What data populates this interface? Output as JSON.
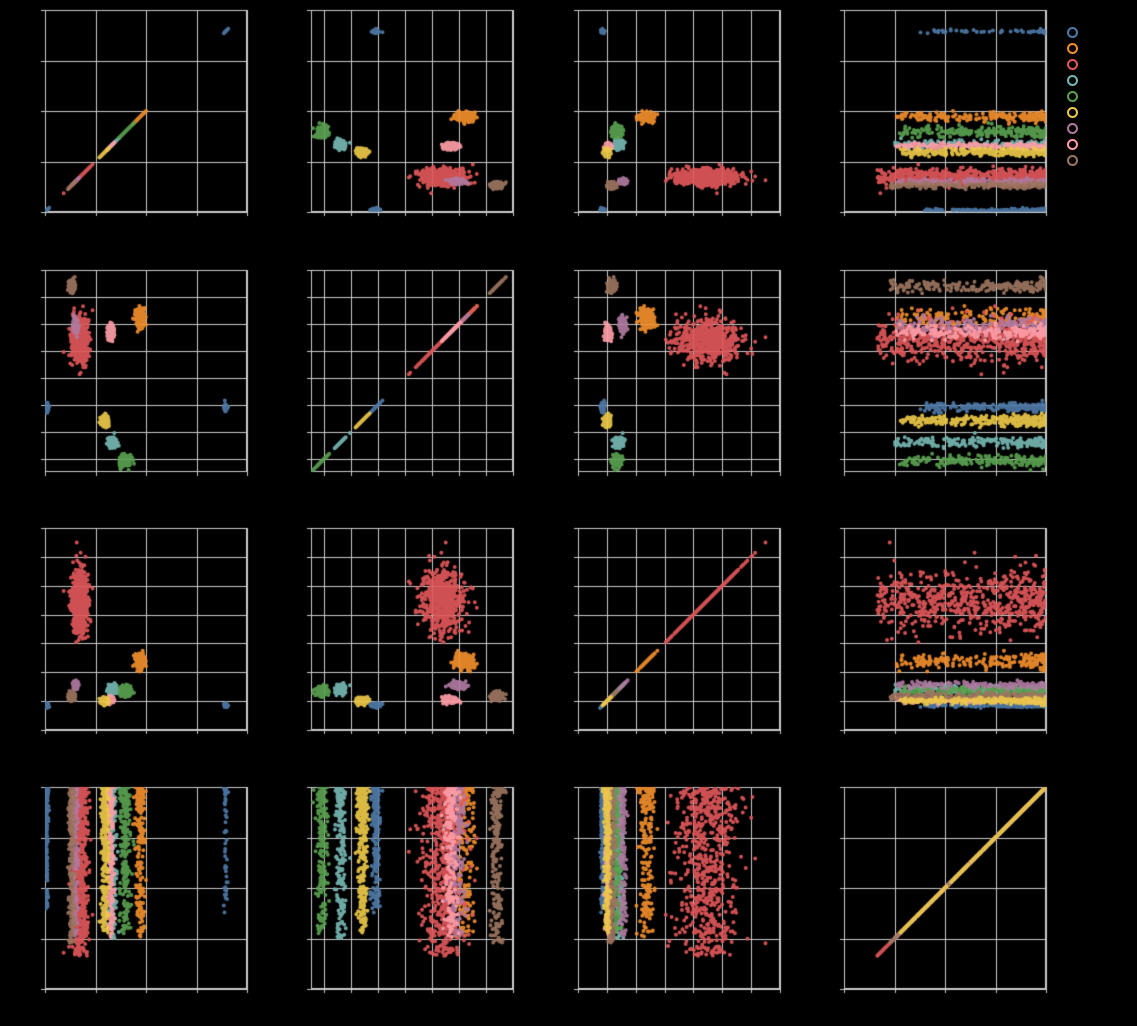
{
  "figure": {
    "width": 1137,
    "height": 1026,
    "background": "#000000",
    "grid_color": "#cbcbcb",
    "spine_color": "#cbcbcb",
    "tick_length": 4,
    "marker_radius": 2.0,
    "marker_alpha": 0.92,
    "visible_text": "none (axis tick labels and legend labels are not visible against the black background)"
  },
  "layout": {
    "axis_size": 202,
    "col_x": [
      45,
      311,
      578,
      844
    ],
    "row_y": [
      10,
      270,
      528,
      787
    ],
    "canvas_pad": 8,
    "legend": {
      "cx": 1072,
      "y_start": 32,
      "y_step": 16,
      "diameter": 11,
      "ring_width": 2.5
    }
  },
  "chart_data": {
    "type": "scatter",
    "subtype": "pairwise-scatter-matrix",
    "rows": 4,
    "cols": 4,
    "title": "",
    "xlabel": "",
    "ylabel": "",
    "axes_note": "subplot(r,c) plots feature c on x vs feature r on y; diagonal panels collapse to y=x lines; all values expressed as fractions [0,1] of each axis range",
    "grid_specs": {
      "f1": {
        "lines": 5,
        "span": 4,
        "offset": 0
      },
      "f2": {
        "lines": 8,
        "span": 7.5,
        "offset": 0.5
      },
      "f3": {
        "lines": 8,
        "span": 7,
        "offset": 0
      },
      "f4": {
        "lines": 5,
        "span": 4,
        "offset": 0
      }
    },
    "features": [
      "f1",
      "f2",
      "f3",
      "f4"
    ],
    "f4_note": "feature 4 is broadly spread within every class: dense near 1.0 thinning toward a per-class minimum; modeled as 1-(1-min)*u^pow",
    "classes": [
      {
        "name": "blue",
        "color": "#4e79a7",
        "count": 230,
        "f1": {
          "components": [
            {
              "mean": 0.008,
              "std": 0.004,
              "weight": 0.74,
              "f4": {
                "min": 0.4,
                "pow": 1.5
              }
            },
            {
              "mean": 0.895,
              "std": 0.005,
              "weight": 0.26,
              "f4": {
                "min": 0.35,
                "pow": 1.4
              }
            }
          ]
        },
        "f2": {
          "mean": 0.322,
          "std": 0.01
        },
        "f3": {
          "mean": 0.122,
          "std": 0.005
        },
        "f4": {
          "min": 0.4,
          "pow": 1.5
        },
        "clip": 3.2
      },
      {
        "name": "orange",
        "color": "#f28e2b",
        "count": 210,
        "f1": {
          "mean": 0.47,
          "std": 0.012
        },
        "f2": {
          "mean": 0.76,
          "std": 0.025
        },
        "f3": {
          "mean": 0.34,
          "std": 0.018
        },
        "f4": {
          "min": 0.26,
          "pow": 1.4
        },
        "clip": 3.2
      },
      {
        "name": "red",
        "color": "#e15759",
        "count": 650,
        "f1": {
          "mean": 0.172,
          "std": 0.02
        },
        "f2": {
          "mean": 0.65,
          "std": 0.05
        },
        "f3": {
          "mean": 0.64,
          "std": 0.075
        },
        "f4": {
          "min": 0.16,
          "pow": 1.3
        },
        "clip": 4.2
      },
      {
        "name": "teal",
        "color": "#76b7b2",
        "count": 200,
        "f1": {
          "mean": 0.335,
          "std": 0.011
        },
        "f2": {
          "mean": 0.148,
          "std": 0.014
        },
        "f3": {
          "mean": 0.2,
          "std": 0.011
        },
        "f4": {
          "min": 0.25,
          "pow": 1.4
        },
        "clip": 3.2
      },
      {
        "name": "green",
        "color": "#59a14f",
        "count": 230,
        "f1": {
          "mean": 0.398,
          "std": 0.014
        },
        "f2": {
          "mean": 0.055,
          "std": 0.014
        },
        "f3": {
          "mean": 0.193,
          "std": 0.011
        },
        "f4": {
          "min": 0.27,
          "pow": 1.4
        },
        "clip": 3.2
      },
      {
        "name": "yellow",
        "color": "#edc948",
        "count": 300,
        "f1": {
          "mean": 0.296,
          "std": 0.009
        },
        "f2": {
          "mean": 0.253,
          "std": 0.013
        },
        "f3": {
          "mean": 0.144,
          "std": 0.007
        },
        "f4": {
          "min": 0.28,
          "pow": 1.4
        },
        "clip": 3.2
      },
      {
        "name": "purple",
        "color": "#b07aa1",
        "count": 160,
        "f1": {
          "mean": 0.15,
          "std": 0.007
        },
        "f2": {
          "mean": 0.728,
          "std": 0.022
        },
        "f3": {
          "mean": 0.222,
          "std": 0.009
        },
        "f4": {
          "min": 0.26,
          "pow": 1.4
        },
        "clip": 3.2
      },
      {
        "name": "pink",
        "color": "#ff9da7",
        "count": 190,
        "f1": {
          "mean": 0.325,
          "std": 0.008
        },
        "f2": {
          "mean": 0.693,
          "std": 0.018
        },
        "f3": {
          "mean": 0.15,
          "std": 0.008
        },
        "f4": {
          "min": 0.25,
          "pow": 1.4
        },
        "clip": 3.2
      },
      {
        "name": "brown",
        "color": "#9c755f",
        "count": 210,
        "f1": {
          "mean": 0.131,
          "std": 0.008
        },
        "f2": {
          "mean": 0.92,
          "std": 0.014
        },
        "f3": {
          "mean": 0.167,
          "std": 0.009
        },
        "f4": {
          "min": 0.23,
          "pow": 1.4
        },
        "clip": 3.2
      }
    ],
    "draw_order": [
      "blue",
      "orange",
      "red",
      "teal",
      "green",
      "purple",
      "pink",
      "brown",
      "yellow"
    ],
    "legend": {
      "position": "right-of-top-right-subplot",
      "marker": "ring",
      "entries": [
        {
          "name": "blue",
          "color": "#4e79a7"
        },
        {
          "name": "orange",
          "color": "#f28e2b"
        },
        {
          "name": "red",
          "color": "#e15759"
        },
        {
          "name": "teal",
          "color": "#76b7b2"
        },
        {
          "name": "green",
          "color": "#59a14f"
        },
        {
          "name": "yellow",
          "color": "#edc948"
        },
        {
          "name": "purple",
          "color": "#b07aa1"
        },
        {
          "name": "pink",
          "color": "#ff9da7"
        },
        {
          "name": "brown",
          "color": "#9c755f"
        }
      ]
    }
  }
}
